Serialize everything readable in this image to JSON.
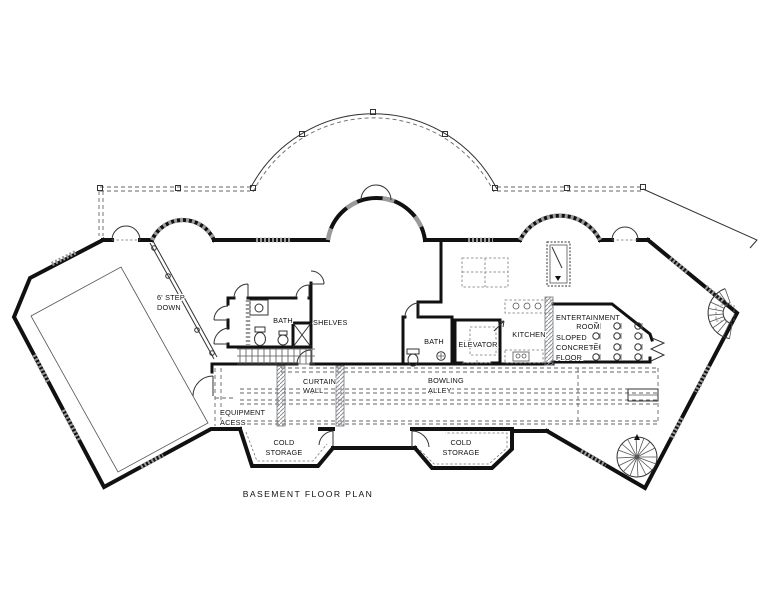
{
  "title": "BASEMENT FLOOR PLAN",
  "rooms": {
    "step_down": {
      "l1": "6' STEP",
      "l2": "DOWN"
    },
    "bath_left": "BATH",
    "shelves": "SHELVES",
    "bath_center": "BATH",
    "elevator": "ELEVATOR",
    "kitchen": "KITCHEN",
    "entertainment": {
      "l1": "ENTERTAINMENT",
      "l2": "ROOM"
    },
    "sloped_floor": {
      "l1": "SLOPED",
      "l2": "CONCRETE",
      "l3": "FLOOR"
    },
    "curtain_wall": {
      "l1": "CURTAIN",
      "l2": "WALL"
    },
    "bowling_alley": {
      "l1": "BOWLING",
      "l2": "ALLEY"
    },
    "equipment_access": {
      "l1": "EQUIPMENT",
      "l2": "ACESS"
    },
    "cold_storage_left": {
      "l1": "COLD",
      "l2": "STORAGE"
    },
    "cold_storage_right": {
      "l1": "COLD",
      "l2": "STORAGE"
    }
  },
  "colors": {
    "wall": "#111111",
    "line": "#444444",
    "window_hatch": "#9a9a9a",
    "background": "#ffffff"
  }
}
